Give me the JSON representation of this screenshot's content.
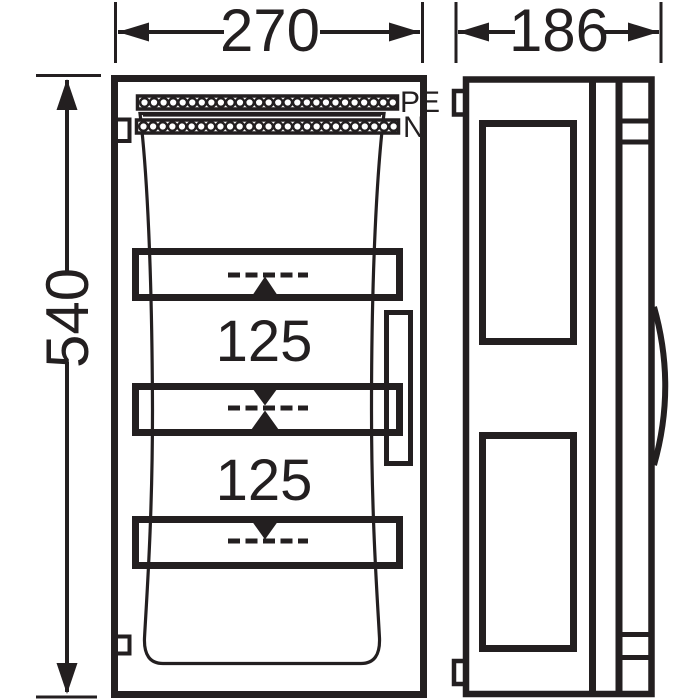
{
  "colors": {
    "line": "#231f20",
    "background": "#ffffff"
  },
  "dimensions": {
    "front_width": "270",
    "side_depth": "186",
    "front_height": "540"
  },
  "front_view": {
    "pe_label": "PE",
    "n_label": "N",
    "rail_spacing_top": "125",
    "rail_spacing_bottom": "125",
    "pe_terminal_count": 27,
    "n_terminal_count": 27,
    "din_rail_count": 3
  }
}
